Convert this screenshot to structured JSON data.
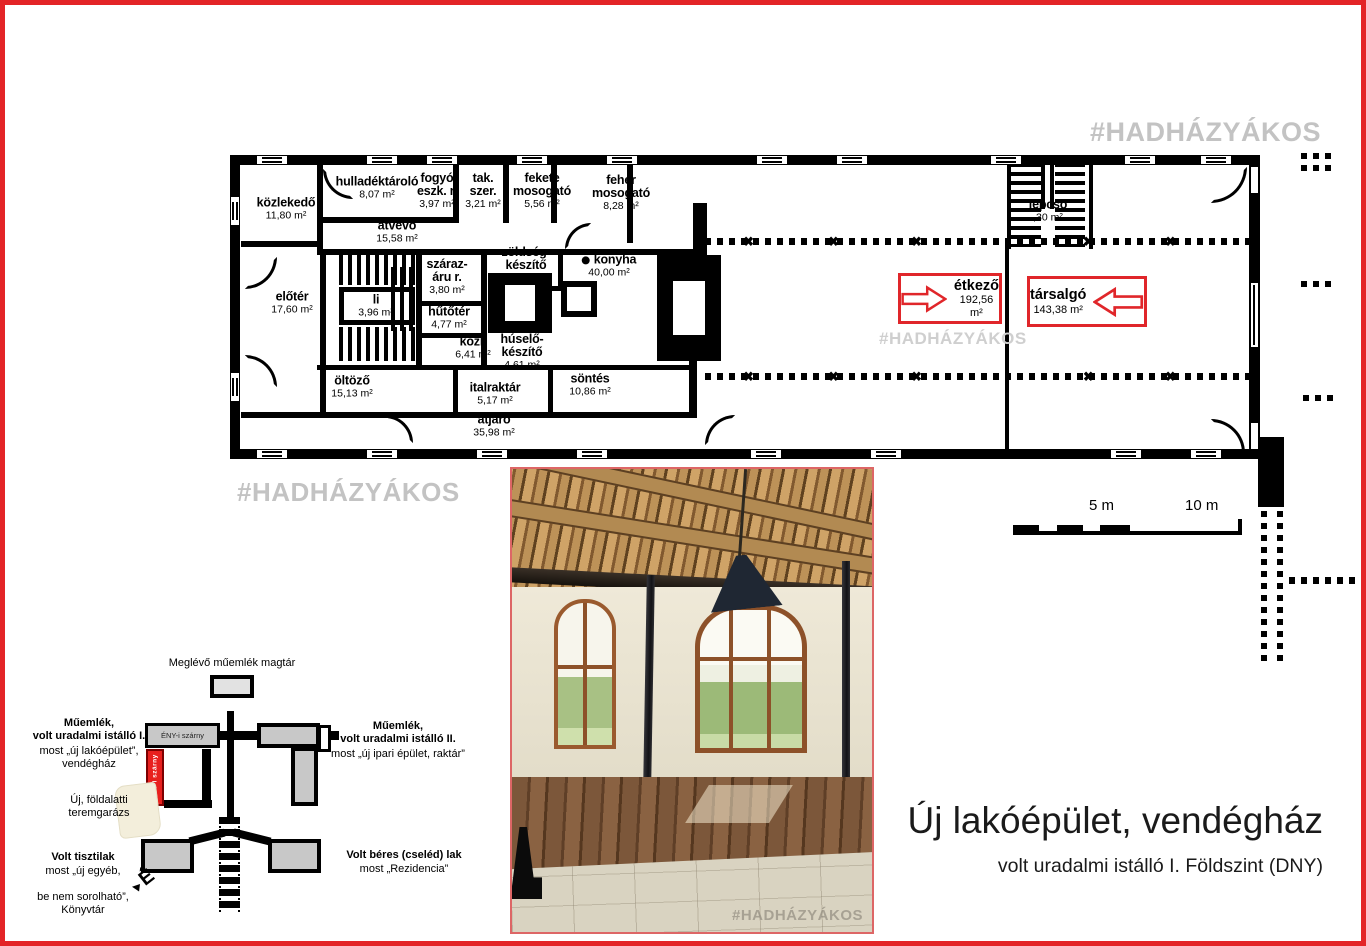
{
  "watermark_text": "#HADHÁZYÁKOS",
  "plan": {
    "rooms": [
      {
        "name": "közlekedő",
        "area": "11,80 m²",
        "x": 281,
        "y": 204
      },
      {
        "name": "hulladéktároló",
        "area": "8,07 m²",
        "x": 372,
        "y": 183
      },
      {
        "name": "fogyó\neszk. r.",
        "area": "3,97 m²",
        "x": 432,
        "y": 186
      },
      {
        "name": "tak.\nszer.",
        "area": "3,21 m²",
        "x": 478,
        "y": 186
      },
      {
        "name": "fekete\nmosogató",
        "area": "5,56 m²",
        "x": 537,
        "y": 186
      },
      {
        "name": "fehér\nmosogató",
        "area": "8,28 m²",
        "x": 616,
        "y": 188
      },
      {
        "name": "átvevő",
        "area": "15,58 m²",
        "x": 392,
        "y": 227
      },
      {
        "name": "zöldség-\nkészítő",
        "area": "4,61 m²",
        "x": 521,
        "y": 260
      },
      {
        "name": "konyha",
        "area": "40,00 m²",
        "x": 604,
        "y": 261,
        "marker": true
      },
      {
        "name": "száraz-\náru r.",
        "area": "3,80 m²",
        "x": 442,
        "y": 272
      },
      {
        "name": "előtér",
        "area": "17,60 m²",
        "x": 287,
        "y": 298
      },
      {
        "name": "li",
        "area": "3,96 m²",
        "x": 371,
        "y": 301
      },
      {
        "name": "hűtőtér",
        "area": "4,77 m²",
        "x": 444,
        "y": 313
      },
      {
        "name": "közl.",
        "area": "6,41 m²",
        "x": 468,
        "y": 343
      },
      {
        "name": "húselő-\nkészítő",
        "area": "4,61 m²",
        "x": 517,
        "y": 347
      },
      {
        "name": "öltöző",
        "area": "15,13 m²",
        "x": 347,
        "y": 382
      },
      {
        "name": "italraktár",
        "area": "5,17 m²",
        "x": 490,
        "y": 389
      },
      {
        "name": "söntés",
        "area": "10,86 m²",
        "x": 585,
        "y": 380
      },
      {
        "name": "átjáró",
        "area": "35,98 m²",
        "x": 489,
        "y": 421
      },
      {
        "name": "lépcső",
        "area": ",30 m²",
        "x": 1043,
        "y": 206
      }
    ],
    "annotations": {
      "etkezo": {
        "label": "étkező",
        "area": "192,56 m²"
      },
      "tarsalgo": {
        "label": "társalgó",
        "area": "143,38 m²"
      }
    },
    "scale": {
      "five_label": "5 m",
      "ten_label": "10 m"
    }
  },
  "site": {
    "magtar_label": "Meglévő műemlék magtár",
    "eny_wing": "ÉNY-i szárny",
    "dny_wing": "DNY-i szárny",
    "left_bold": "Műemlék,\nvolt uradalmi istálló I.",
    "left_normal": "most „új lakóépület”,\nvendégház",
    "right_bold": "Műemlék,\nvolt uradalmi istálló II.",
    "right_normal": "most „új ipari épület, raktár”",
    "garage_label": "Új, földalatti\nteremgarázs",
    "tisztilak_bold": "Volt tisztilak",
    "tisztilak_normal": "most „új egyéb,",
    "tisztilak_more": "be nem sorolható”,\nKönyvtár",
    "beres_bold": "Volt béres (cseléd) lak",
    "beres_normal": "most „Rezidencia”",
    "compass": "É"
  },
  "photo": {
    "watermark": "#HADHÁZYÁKOS"
  },
  "title": {
    "main": "Új lakóépület, vendégház",
    "subtitle": "volt uradalmi istálló I. Földszint (DNY)"
  },
  "colors": {
    "page_border": "#e32427",
    "annotation_red": "#e0262a",
    "watermark_gray": "#c3c3c3"
  }
}
